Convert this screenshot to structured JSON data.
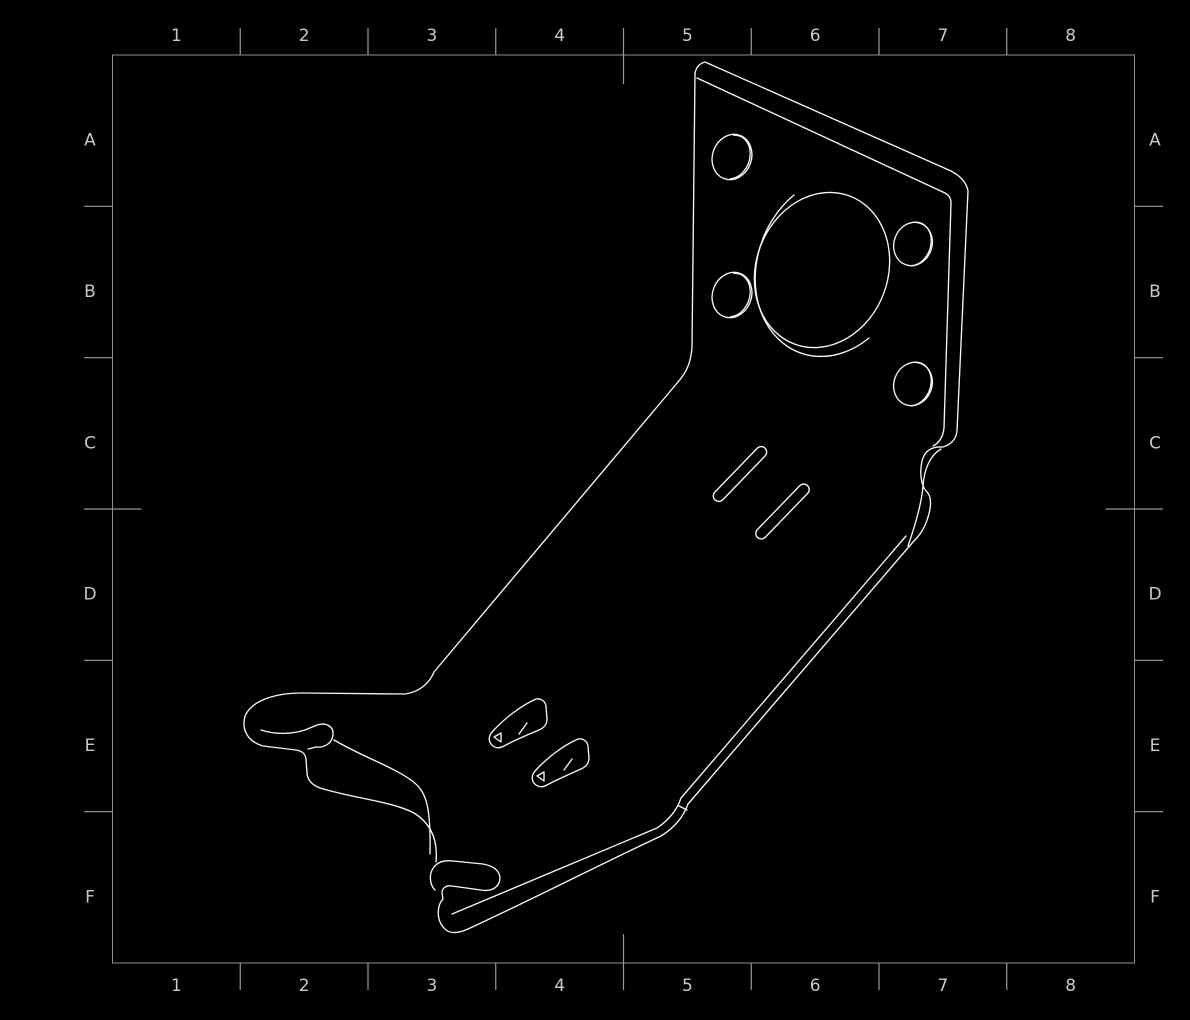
{
  "drawing": {
    "background": "#000000",
    "part_line_color": "#f5f5f5",
    "part_line_width": 1.35,
    "frame_color": "#8f8f8f",
    "tick_color": "#9a9a9a",
    "label_color": "#c9c9c9",
    "label_font_size": 17,
    "grid": {
      "columns": [
        "1",
        "2",
        "3",
        "4",
        "5",
        "6",
        "7",
        "8"
      ],
      "rows": [
        "A",
        "B",
        "C",
        "D",
        "E",
        "F"
      ]
    },
    "part": {
      "paths": [
        {
          "name": "bracket-silhouette-right",
          "d": "M 695,73 Q 697,64 705,62 L 951,171 Q 966,179 968,191 L 957,431 C 956,440 950,445 943,447 C 929,446 922,453 921,468 C 920,480 923,488 927,492 C 932,497 931,508 928,517 C 925,528 920,535 913,542 L 688,804 C 683,818 674,828 661,836 C 597,866 531,900 468,929 C 457,934 449,934 444,928 C 436,920 437,905 443,899 L 442,893 C 442,888 446,885 452,886 L 481,890 C 492,892 499,887 500,879 C 500,871 494,866 483,864 L 453,861 C 445,860 438,862 434,867 C 429,873 429,884 435,890"
        },
        {
          "name": "bracket-silhouette-left",
          "d": "M 695,73 L 692,347 C 691,363 686,373 678,382 L 434,672 C 429,684 419,692 405,694 L 302,693 C 276,693 252,700 245,716 C 241,731 249,742 263,746 L 296,750 C 303,751 306,755 306,760 L 307,772 C 307,780 312,785 320,788 C 356,799 391,801 414,813 C 432,824 438,841 436,862"
        },
        {
          "name": "left-hook-slot",
          "d": "M 261,730 C 276,735 293,734 305,730 L 317,725 C 327,722 334,727 333,735 C 332,743 325,748 316,747 L 308,749"
        },
        {
          "name": "s-bend-inner-edge",
          "d": "M 334,740 C 363,757 391,766 411,780 C 426,791 431,804 430,854"
        },
        {
          "name": "arm-inner-right-edge",
          "d": "M 906,536 L 681,798 C 677,810 669,820 657,828 L 452,914"
        },
        {
          "name": "foot-bend-tick",
          "d": "M 679,806 L 687,810"
        },
        {
          "name": "plate-inner-top-right-edge",
          "d": "M 697,78 L 945,193 Q 951,196 951,203 L 944,428 C 943,437 939,443 933,446"
        },
        {
          "name": "relief-notch-inner-line",
          "d": "M 941,449 C 930,455 924,470 923,486 C 922,500 917,520 908,546"
        },
        {
          "name": "center-hole-inner-wall",
          "d": "M 794,195 A 58 72 20 0 0 869,338"
        },
        {
          "name": "hole1-inner-wall",
          "d": "M 733.6,135.2 A 15 19 20 0 1 730.4,178.8"
        },
        {
          "name": "hole2-inner-wall",
          "d": "M 914.6,222.2 A 15 19 20 0 1 911.4,265.8"
        },
        {
          "name": "hole3-inner-wall",
          "d": "M 733.6,273.2 A 15 19 20 0 1 730.4,316.8"
        },
        {
          "name": "hole4-inner-wall",
          "d": "M 914.6,362.2 A 15 19 20 0 1 911.4,405.8"
        },
        {
          "name": "curved-slot-a",
          "d": "M 536,699 C 541,698 545,701 546,706 L 547,719 C 547,724 544,728 539,730 C 527,735 513,741 504,746 C 499,749 494,748 491,744 C 488,740 489,735 493,731 C 503,720 520,706 536,699 Z"
        },
        {
          "name": "curved-slot-a-detail",
          "d": "M 519,734 L 527,723 M 494,737 L 501,733 L 501,742 Z"
        },
        {
          "name": "curved-slot-b",
          "d": "M 578,739 C 583,738 587,741 588,746 L 589,758 C 589,763 586,767 581,769 C 570,774 556,780 547,785 C 542,788 537,787 534,783 C 531,779 532,774 536,770 C 546,759 562,746 578,739 Z"
        },
        {
          "name": "curved-slot-b-detail",
          "d": "M 564,770 L 572,759 M 537,776 L 544,772 L 544,781 Z"
        }
      ],
      "ellipses": [
        {
          "name": "center-hole-outer",
          "cx": 822,
          "cy": 270,
          "rx": 66,
          "ry": 79,
          "rot": 20
        },
        {
          "name": "hole1-outer",
          "cx": 732,
          "cy": 157,
          "rx": 19.5,
          "ry": 23,
          "rot": 20
        },
        {
          "name": "hole2-outer",
          "cx": 913,
          "cy": 244,
          "rx": 19,
          "ry": 22,
          "rot": 20
        },
        {
          "name": "hole3-outer",
          "cx": 732,
          "cy": 295,
          "rx": 19.5,
          "ry": 23,
          "rot": 20
        },
        {
          "name": "hole4-outer",
          "cx": 913,
          "cy": 384,
          "rx": 19,
          "ry": 22,
          "rot": 20
        }
      ],
      "slots": [
        {
          "name": "straight-slot-1",
          "cx": 740,
          "cy": 474,
          "length": 72,
          "width": 11,
          "rot": -46
        },
        {
          "name": "straight-slot-2",
          "cx": 782.5,
          "cy": 511.5,
          "length": 72,
          "width": 11,
          "rot": -46
        }
      ]
    }
  }
}
